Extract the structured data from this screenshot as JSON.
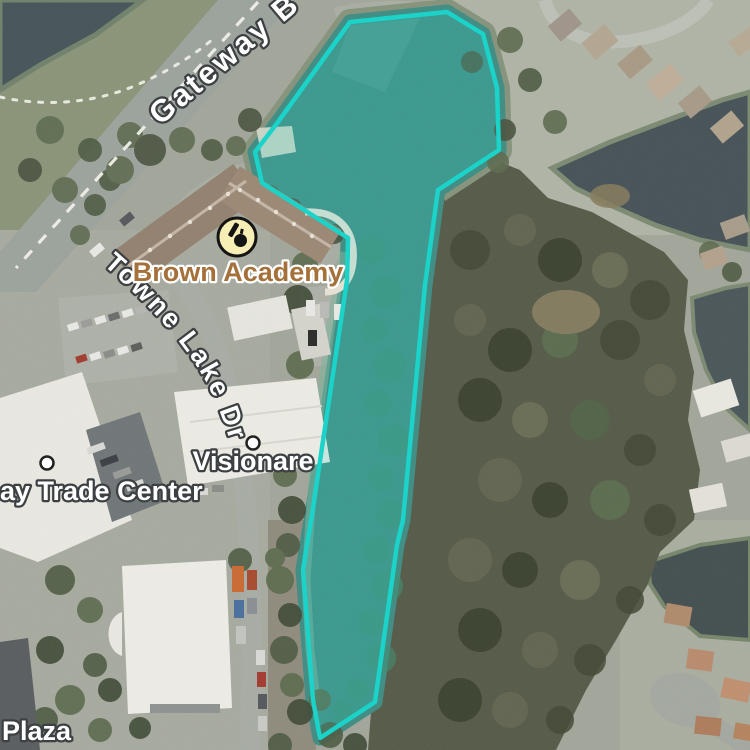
{
  "map": {
    "overlay": {
      "name": "highlighted-parcel",
      "stroke_color": "#1bd3c8",
      "fill_color": "rgba(47,213,201,0.17)"
    },
    "labels": {
      "gateway_blvd": "Gateway B",
      "towne_lake_dr": "Towne Lake Dr",
      "brown_academy": "Brown Academy",
      "visionare": "Visionare",
      "trade_center": "ay Trade Center",
      "plaza": "Plaza"
    },
    "icons": {
      "school": "school-icon"
    }
  }
}
